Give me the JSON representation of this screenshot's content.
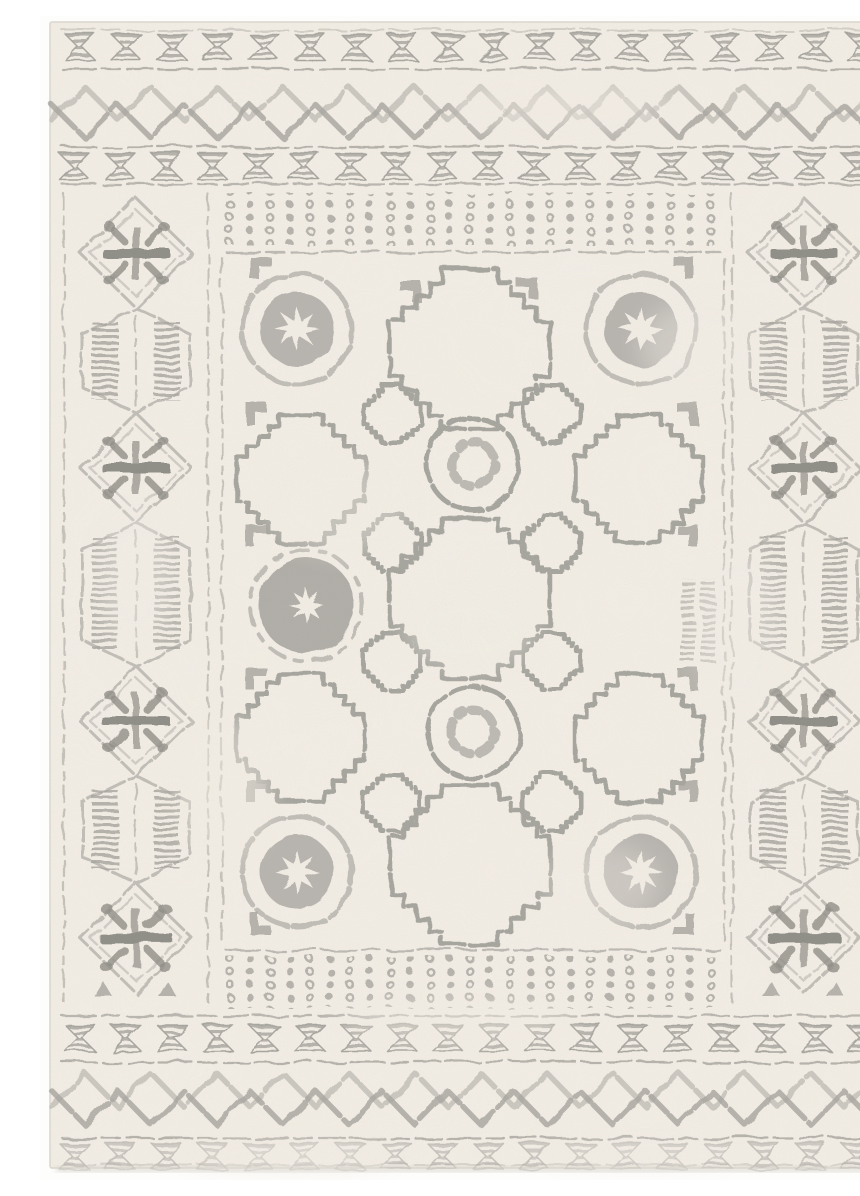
{
  "image": {
    "kind": "product photo",
    "alt": "Distressed Moroccan tribal style area rug, ivory cream pile with faded grey geometric pattern, viewed flat from above on a white backdrop",
    "background": "white studio backdrop"
  },
  "palette": {
    "photo_bg": "#fdfdfc",
    "rug_base": "#f3eee5",
    "rug_mottle": "#e9dfd0",
    "ink_light": "#bdbab3",
    "ink_mid": "#a09e98",
    "ink_dark": "#87857f",
    "edge_shadow": "#d9d5ce"
  },
  "rug": {
    "style": "Moroccan tribal, distressed ivory and grey",
    "top_bottom_bands": {
      "hourglass_rows": 4,
      "hourglasses_per_row": 18,
      "zigzag_bands": 2,
      "zigzag_lines_per_band": 2,
      "separator_line_style": "broken dashed grey lines"
    },
    "side_borders": {
      "columns": 2,
      "snowflake_diamonds_per_column": 4,
      "striped_hexagons_per_column": 3,
      "stitch_lines": "vertical dashed guide lines"
    },
    "field": {
      "dot_bands": 2,
      "dot_rows_per_band": 4,
      "ring_medallions": 4,
      "small_ring_medallions": 2,
      "filled_gear_medallions": 1,
      "stepped_crosses_large": 3,
      "stepped_crosses_medium": 4,
      "stepped_squares": 8,
      "hook_motifs": 12
    }
  }
}
